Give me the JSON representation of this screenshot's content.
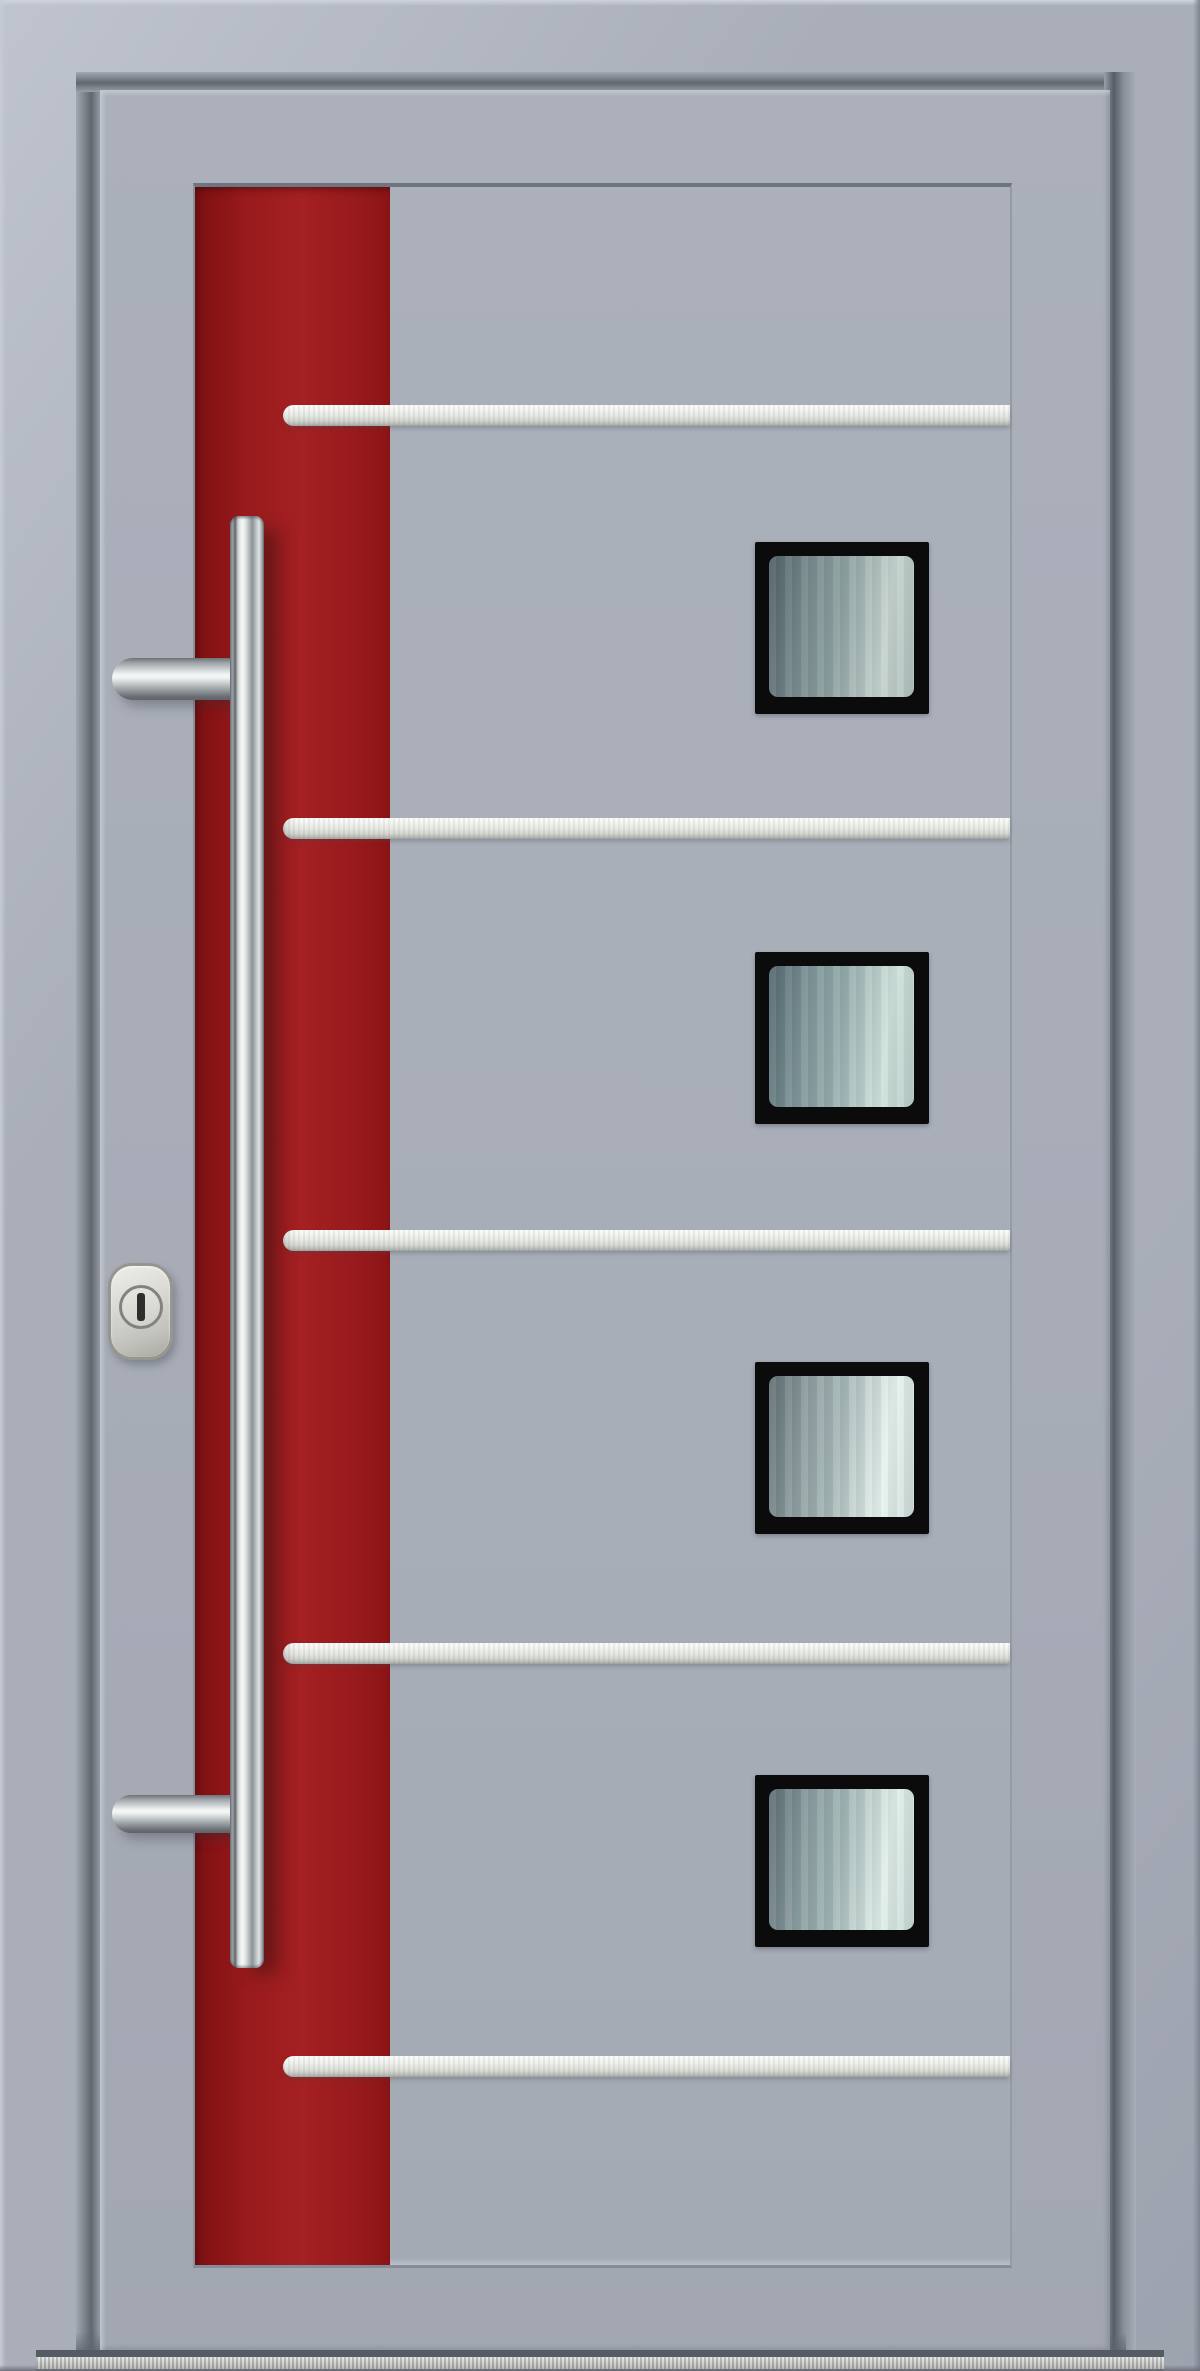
{
  "image": {
    "type": "product-photo",
    "subject": "Modern aluminum entry door, front view",
    "text_content": "none"
  },
  "colors": {
    "frame-gray": "#a9aeb9",
    "frame-gray-light": "#bfc4ce",
    "frame-gray-dark": "#868c97",
    "leaf-gray": "#a7acb7",
    "panel-gray": "#abb0bb",
    "groove-dark": "#5f656f",
    "stripe-red": "#9a1b1d",
    "stripe-red-dark": "#6b0e10",
    "stripe-red-bright": "#a42022",
    "bar-silver-light": "#f4f5f2",
    "bar-silver": "#e6e8e3",
    "bar-silver-dark": "#b4b8b3",
    "glazing-frame-black": "#0b0b0b",
    "glass-dark": "#53646a",
    "glass-mid": "#93a7a7",
    "glass-light": "#cddcd7",
    "steel-dark": "#6e747a",
    "steel-light": "#f0f2f2",
    "lock-silver": "#d9d9d3",
    "lock-edge": "#96968f",
    "keyhole-dark": "#2e2e2c",
    "threshold-silver": "#c9cbc6"
  },
  "door": {
    "frame": {
      "label": "door-frame",
      "finish": "light-gray-aluminum"
    },
    "leaf": {
      "label": "door-leaf",
      "finish": "light-gray-aluminum"
    },
    "decor_panel": {
      "label": "recessed-center-panel"
    },
    "decor_stripe": {
      "label": "red-accent-stripe",
      "position": "left-edge-of-panel"
    },
    "horizontal_bars": {
      "count": 5,
      "finish": "brushed-stainless",
      "left_end": "rounded",
      "right_end": "flush-with-panel-edge"
    },
    "glazings": {
      "count": 4,
      "shape": "square",
      "frame": "black",
      "glass": "frosted-gradient-reflective"
    },
    "handle": {
      "type": "vertical-bar-pull",
      "finish": "stainless-steel",
      "mounts": 2,
      "side": "left-over-red-stripe"
    },
    "lock": {
      "type": "security-escutcheon",
      "cylinder": "round-ring",
      "keyhole": "vertical-slot"
    },
    "threshold": {
      "finish": "brushed-aluminum",
      "position": "bottom-full-width"
    }
  }
}
